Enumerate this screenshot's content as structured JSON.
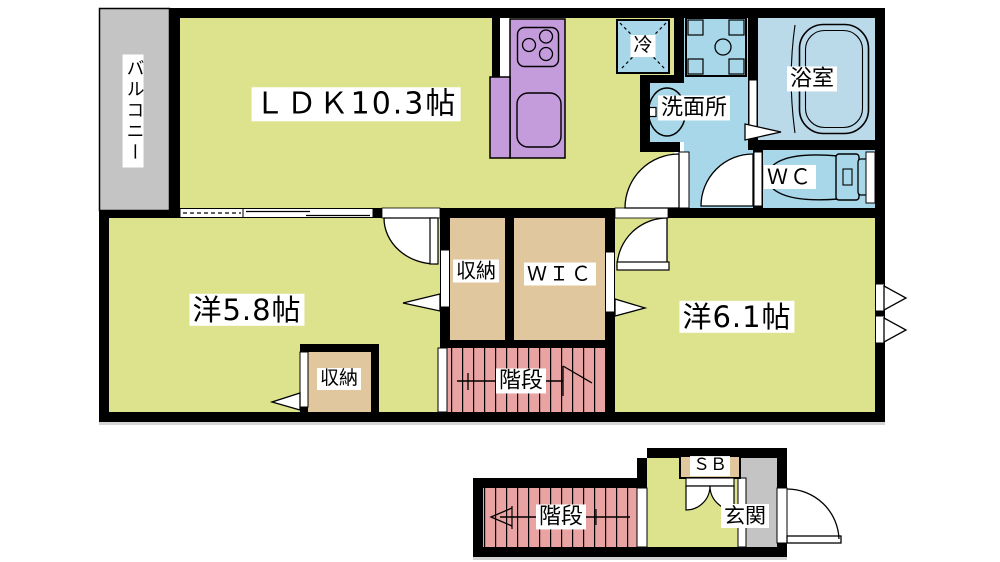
{
  "colors": {
    "wall": "#000000",
    "room_yellow": "#dde28d",
    "closet_tan": "#e0c79e",
    "stairs_pink": "#e9a3a3",
    "water_cyan": "#a7d7e8",
    "bath_blue": "#bad9e9",
    "kitchen_purple": "#c49bdb",
    "gray_area": "#c4c4c4",
    "label_bg": "#ffffff"
  },
  "rooms": {
    "balcony": {
      "label": "バルコニー"
    },
    "ldk": {
      "label": "ＬＤＫ10.3帖"
    },
    "refrigerator": {
      "label": "冷"
    },
    "washroom": {
      "label": "洗面所"
    },
    "bathroom": {
      "label": "浴室"
    },
    "toilet": {
      "label": "ＷＣ"
    },
    "western_room_5_8": {
      "label": "洋5.8帖"
    },
    "closet_a": {
      "label": "収納"
    },
    "closet_b": {
      "label": "収納"
    },
    "walk_in_closet": {
      "label": "ＷＩＣ"
    },
    "western_room_6_1": {
      "label": "洋6.1帖"
    },
    "stairs_upper": {
      "label": "階段"
    },
    "stairs_lower": {
      "label": "階段"
    },
    "shoe_box": {
      "label": "ＳＢ"
    },
    "entrance": {
      "label": "玄関"
    }
  }
}
